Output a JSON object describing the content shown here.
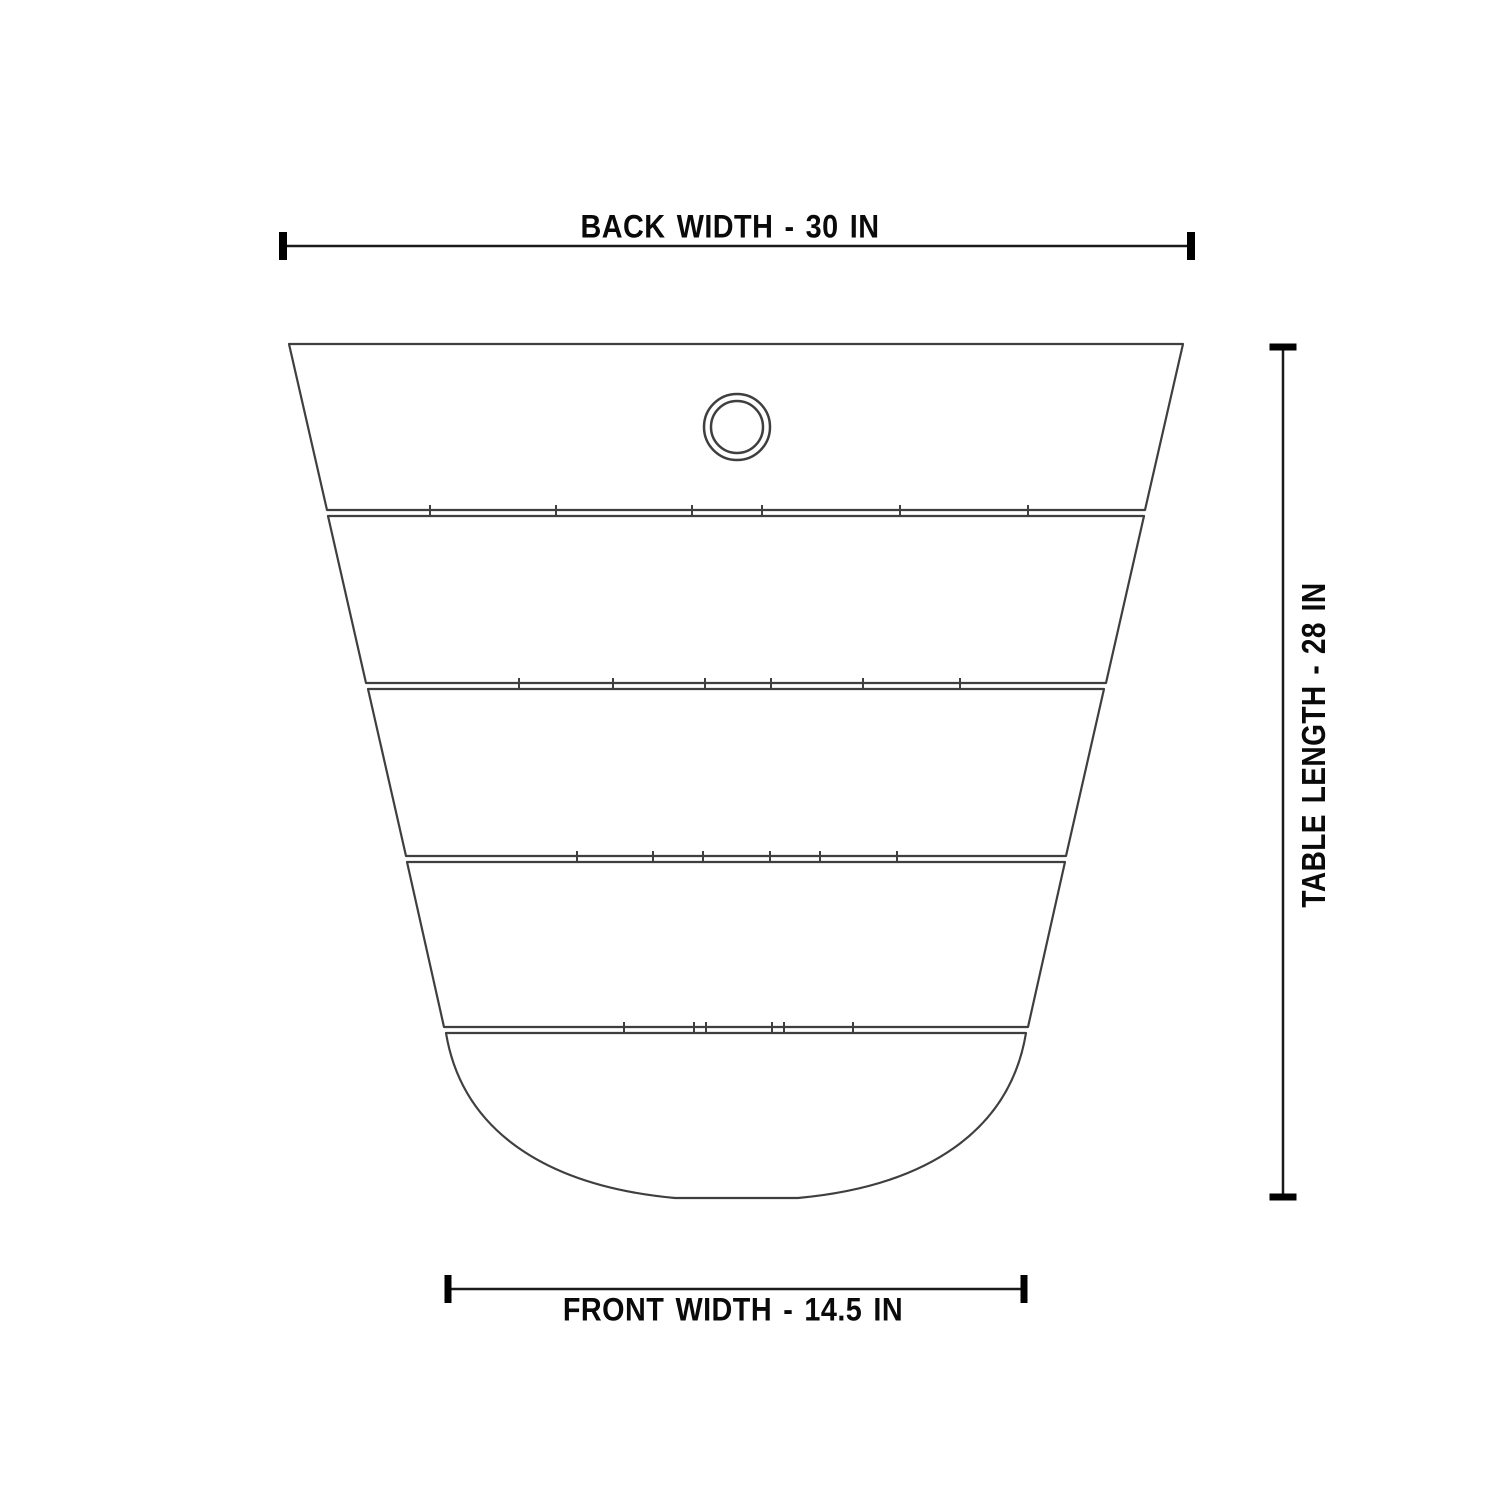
{
  "diagram": {
    "labels": {
      "back_width": "BACK WIDTH - 30 IN",
      "table_length": "TABLE LENGTH - 28 IN",
      "front_width": "FRONT WIDTH - 14.5 IN"
    },
    "values": {
      "back_width_in": 30,
      "table_length_in": 28,
      "front_width_in": 14.5,
      "units": "IN"
    },
    "colors": {
      "background": "#ffffff",
      "outline": "#3f3f3f",
      "dimension_line": "#1a1a1a",
      "dimension_tick": "#000000",
      "text": "#0a0a0a"
    },
    "geometry": {
      "slats": [
        {
          "name": "slat-1",
          "points": "289,344 1183,344 1145,510 327,510"
        },
        {
          "name": "slat-2",
          "points": "328,516 1144,516 1106,683 366,683"
        },
        {
          "name": "slat-3",
          "points": "368,689 1104,689 1066,856 406,856"
        },
        {
          "name": "slat-4",
          "points": "407,862 1065,862 1028,1027 444,1027"
        }
      ],
      "front_piece_path": "M 446,1033 L 1026,1033 C 1010,1130 928,1186 798,1198 L 675,1198 C 545,1186 462,1130 446,1033 Z",
      "seams": [
        {
          "y": 510,
          "ticks": [
            430,
            556,
            692,
            762,
            900,
            1028
          ]
        },
        {
          "y": 683,
          "ticks": [
            519,
            613,
            705,
            771,
            863,
            960
          ]
        },
        {
          "y": 856,
          "ticks": [
            577,
            653,
            703,
            770,
            820,
            897
          ]
        },
        {
          "y": 1027,
          "ticks": [
            624,
            694,
            706,
            772,
            784,
            853
          ]
        }
      ],
      "tick_half_height": 5,
      "umbrella_hole": {
        "cx": 737,
        "cy": 427,
        "r_outer": 33,
        "r_inner": 26,
        "stroke": 2.5
      },
      "outline_stroke": 2.2,
      "dim_back": {
        "orient": "h",
        "y": 246,
        "x1": 283,
        "x2": 1191,
        "tick_w": 8,
        "tick_h": 28,
        "line_w": 2.5
      },
      "dim_front": {
        "orient": "h",
        "y": 1289,
        "x1": 448,
        "x2": 1024,
        "tick_w": 7,
        "tick_h": 28,
        "line_w": 2.5
      },
      "dim_length": {
        "orient": "v",
        "x": 1283,
        "y1": 347,
        "y2": 1197,
        "tick_w": 27,
        "tick_h": 7,
        "line_w": 2.5
      }
    }
  }
}
